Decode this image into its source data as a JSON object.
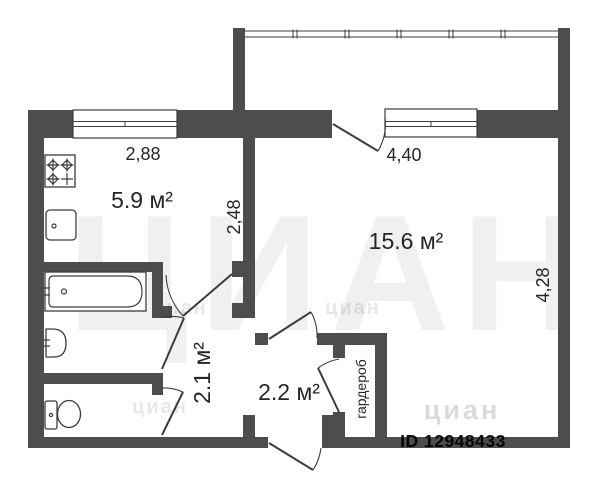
{
  "plan": {
    "rooms": {
      "kitchen_area": "5.9 м²",
      "living_area": "15.6 м²",
      "corridor_area": "2.1 м²",
      "hall_area": "2.2 м²",
      "wardrobe_label": "гардероб"
    },
    "dimensions": {
      "kitchen_width": "2,88",
      "kitchen_depth": "2,48",
      "living_width": "4,40",
      "living_depth": "4,28"
    },
    "fixtures": [
      "stove-icon",
      "kitchen-sink-icon",
      "bathtub-icon",
      "washbasin-icon",
      "toilet-icon"
    ],
    "watermark": {
      "brand_large": "ЦИАН",
      "brand_small": "циан",
      "listing_id": "ID 12948433"
    },
    "colors": {
      "wall_color": "#4d4d4d",
      "line_color": "#3c3c3c",
      "text_color": "#262626",
      "watermark_base_color": "#000000",
      "watermark_id_color": "#9c9c9c"
    }
  }
}
